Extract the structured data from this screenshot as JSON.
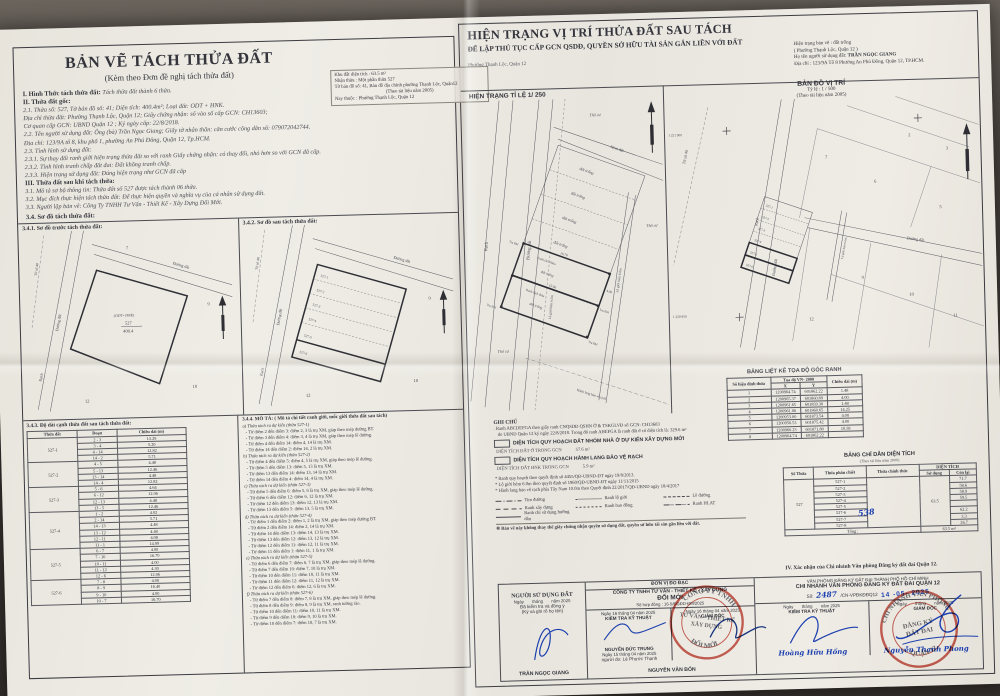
{
  "left": {
    "title": "BẢN VẼ TÁCH THỬA ĐẤT",
    "subtitle": "(Kèm theo Đơn đề nghị tách thửa đất)",
    "lines": [
      {
        "b": "I. Hình Thức tách thửa đất:",
        "t": "Tách thửa đất thành 6 thửa."
      },
      {
        "b": "II. Thửa đất gốc:",
        "t": ""
      },
      {
        "b": "",
        "t": "2.1. Thửa số: 527, Tờ bản đồ số: 41; Diện tích: 400.4m²; Loại đất: ODT + HNK."
      },
      {
        "b": "",
        "t": "Địa chỉ thửa đất: Phường Thạnh Lộc, Quận 12; Giấy chứng nhận: số vào sổ cấp GCN: CH13603;"
      },
      {
        "b": "",
        "t": "Cơ quan cấp GCN: UBND Quận 12 ; Ký ngày cấp: 22/8/2018."
      },
      {
        "b": "",
        "t": "2.2. Tên người sử dụng đất: Ông (bà) Trần Ngọc Giang; Giấy tờ nhân thân: căn cước công dân số: 079072042744."
      },
      {
        "b": "",
        "t": "Địa chỉ: 123/9A tổ 8, khu phố 1, phường An Phú Đông, Quận 12, Tp.HCM."
      },
      {
        "b": "",
        "t": "2.3. Tình hình sử dụng đất:"
      },
      {
        "b": "",
        "t": "2.3.1. Sự thay đổi ranh giới hiện trạng thửa đất so với ranh Giấy chứng nhận: có thay đổi, nhỏ hơn so với GCN đã cấp."
      },
      {
        "b": "",
        "t": "2.3.2. Tình hình tranh chấp đất đai: Đất không tranh chấp."
      },
      {
        "b": "",
        "t": "2.3.3. Hiện trạng sử dụng đất: Đúng hiện trạng như GCN đã cấp"
      },
      {
        "b": "III. Thửa đất sau khi tách thửa:",
        "t": ""
      },
      {
        "b": "",
        "t": "3.1. Mô tả sơ bộ thông tin: Thửa đất số 527 được tách thành 06 thửa."
      },
      {
        "b": "",
        "t": "3.2. Mục đích thực hiện tách thửa đất: Để thực hiện quyền và nghĩa vụ của cá nhân sử dụng đất."
      },
      {
        "b": "",
        "t": "3.3. Người lập bản vẽ: Công Ty TNHH Tư Vấn - Thiết Kế - Xây Dựng Đổi Mới."
      }
    ],
    "so_do_label": "3.4. Sơ đồ tách thửa đất:",
    "sketch1_title": "3.4.1. Sơ đồ trước tách thửa đất:",
    "sketch2_title": "3.4.2. Sơ đồ sau tách thửa đất:",
    "sketch": {
      "to_so": "Tờ số 40",
      "rach": "Rạch",
      "duong_dat": "Đường đất",
      "parcel_type": "(ODT+HNK)",
      "parcel_no": "527",
      "parcel_area": "400.4",
      "n7": "7",
      "n9": "9",
      "n10": "10",
      "n12": "12",
      "strips": [
        "527-1",
        "527-2",
        "527-3",
        "527-4",
        "527-5",
        "527-6"
      ]
    },
    "seg": {
      "title": "3.4.3. Độ dài cạnh thửa đất sau tách thửa đất:",
      "headers": [
        "Thửa đất",
        "Đoạn",
        "Chiều dài (m)"
      ],
      "groups": [
        {
          "id": "527-1",
          "rows": [
            [
              "2 - 3",
              "13.29"
            ],
            [
              "3 - 4",
              "5.20"
            ],
            [
              "4 - 14",
              "12.82"
            ],
            [
              "14 - 2",
              "5.71"
            ]
          ]
        },
        {
          "id": "527-2",
          "rows": [
            [
              "4 - 5",
              "4.48"
            ],
            [
              "5 - 13",
              "12.46"
            ],
            [
              "13 - 14",
              "4.48"
            ],
            [
              "14 - 4",
              "12.82"
            ]
          ]
        },
        {
          "id": "527-3",
          "rows": [
            [
              "5 - 6",
              "4.64"
            ],
            [
              "6 - 12",
              "12.06"
            ],
            [
              "12 - 13",
              "4.48"
            ],
            [
              "13 - 5",
              "12.46"
            ]
          ]
        },
        {
          "id": "527-4",
          "rows": [
            [
              "1 - 2",
              "4.02"
            ],
            [
              "2 - 14",
              "5.71"
            ],
            [
              "14 - 13",
              "4.48"
            ],
            [
              "13 - 12",
              "4.48"
            ],
            [
              "12 - 11",
              "4.08"
            ],
            [
              "11 - 1",
              "14.99"
            ]
          ]
        },
        {
          "id": "527-5",
          "rows": [
            [
              "6 - 7",
              "4.00"
            ],
            [
              "7 - 10",
              "16.70"
            ],
            [
              "10 - 11",
              "4.00"
            ],
            [
              "11 - 12",
              "4.30"
            ],
            [
              "12 - 6",
              "12.06"
            ]
          ]
        },
        {
          "id": "527-6",
          "rows": [
            [
              "7 - 8",
              "4.00"
            ],
            [
              "8 - 9",
              "16.40"
            ],
            [
              "9 - 10",
              "4.00"
            ],
            [
              "10 - 7",
              "16.70"
            ]
          ]
        }
      ]
    },
    "desc": {
      "title": "3.4.4. MÔ TẢ: ( Mô tả chi tiết ranh giới, mốc giới thửa đất sau tách)",
      "sections": [
        {
          "h": "a) Thửa tách ra dự kiến (thửa 527-1)",
          "lines": [
            "Từ điểm 2 đến điểm 3: điểm 2, 3 là trụ XM, giáp theo mép đường BT.",
            "Từ điểm 3 đến điểm 4: điểm 3, 4 là trụ XM, giáp theo mép lề đường.",
            "Từ điểm 4 đến điểm 14: điểm 4, 14 là trụ XM.",
            "Từ điểm 14 đến điểm 2: điểm 14, 2 là trụ XM."
          ]
        },
        {
          "h": "b) Thửa tách ra dự kiến (thửa 527-2)",
          "lines": [
            "Từ điểm 4 đến điểm 5: điểm 4, 5 là trụ XM, giáp theo mép lề đường.",
            "Từ điểm 5 đến điểm 13: điểm 5, 13 là trụ XM.",
            "Từ điểm 13 đến điểm 14: điểm 13, 14 là trụ XM.",
            "Từ điểm 14 đến điểm 4: điểm 14, 4 là trụ XM."
          ]
        },
        {
          "h": "c) Thửa tách ra dự kiến (thửa 527-3)",
          "lines": [
            "Từ điểm 5 đến điểm 6: điểm 5, 6 là trụ XM, giáp theo mép lề đường.",
            "Từ điểm 6 đến điểm 12: điểm 6, 12 là trụ XM.",
            "Từ điểm 12 đến điểm 13: điểm 12, 13 là trụ XM.",
            "Từ điểm 13 đến điểm 5: điểm 13, 5 là trụ XM."
          ]
        },
        {
          "h": "d) Thửa tách ra dự kiến (thửa 527-4)",
          "lines": [
            "Từ điểm 1 đến điểm 2: điểm 1, 2 là trụ XM, giáp theo mép đường BT.",
            "Từ điểm 2 đến điểm 14: điểm 2, 14 là trụ XM.",
            "Từ điểm 14 đến điểm 13: điểm 14, 13 là trụ XM.",
            "Từ điểm 13 đến điểm 12: điểm 13, 12 là trụ XM.",
            "Từ điểm 12 đến điểm 11: điểm 12, 11 là trụ XM.",
            "Từ điểm 11 đến điểm 1: điểm 11, 1 là trụ XM."
          ]
        },
        {
          "h": "e) Thửa tách ra dự kiến (thửa 527-5)",
          "lines": [
            "Từ điểm 6 đến điểm 7: điểm 6, 7 là trụ XM, giáp theo mép lề đường.",
            "Từ điểm 7 đến điểm 10: điểm 7, 10 là trụ XM.",
            "Từ điểm 10 đến điểm 11: điểm 10, 11 là trụ XM.",
            "Từ điểm 11 đến điểm 12: điểm 11, 12 là trụ XM.",
            "Từ điểm 12 đến điểm 6: điểm 12, 6 là trụ XM."
          ]
        },
        {
          "h": "f) Thửa tách ra dự kiến (thửa 527-6)",
          "lines": [
            "Từ điểm 7 đến điểm 8: điểm 7, 8 là trụ XM, giáp theo mép lề đường.",
            "Từ điểm 8 đến điểm 9: điểm 8, 9 là trụ XM, ranh tường rào.",
            "Từ điểm 10 đến điểm 11: điểm 10, 11 là trụ XM.",
            "Từ điểm 9 đến điểm 10: điểm 9, 10 là trụ XM.",
            "Từ điểm 10 đến điểm 7: điểm 10, 7 là trụ XM."
          ]
        }
      ]
    }
  },
  "right": {
    "title": "HIỆN TRẠNG VỊ TRÍ THỬA ĐẤT SAU TÁCH",
    "subtitle": "ĐỂ LẬP THỦ TỤC CẤP GCN QSDĐ, QUYỀN SỞ HỮU TÀI SẢN GẮN LIỀN VỚI ĐẤT",
    "locality": "Phường Thạnh Lộc, Quận 12",
    "info": {
      "l1": "Hiện trạng bản vẽ : đất trống",
      "l2": "( Phường Thạnh Lộc, Quận 12 )",
      "l3a": "Họ tên người sử dụng đất: ",
      "l3b": "TRẦN NGỌC GIANG",
      "l4": "Địa chỉ : 123/9A Tổ 8 Phường An Phú Đông, Quận 12, TP.HCM."
    },
    "khu": {
      "l1": "Khu đất diện tích :  63.5 m²",
      "l2": "Nhận thửa : Một phần thửa 527",
      "l3": "Tờ bản đồ số: 41, Bản đồ địa chính phường Thạnh Lộc, Quận12",
      "l4": "(Theo tài liệu năm 2005)",
      "l5": "Nay thuộc : Phường Thạnh Lộc, Quận 12"
    },
    "maps": {
      "hientrang": {
        "header": "HIỆN TRẠNG TỈ LỆ 1/ 250",
        "rach": "Rạch",
        "duong_dat": "Đường đất",
        "hem": "Hẻm đất",
        "lo_gioi": "Lộ giới hẻm 6.0m",
        "dat_trong": "đất trống",
        "tru": "Trụ BM",
        "tho_cu": "Thổ cư",
        "ranh_tach": "Ranh tách thửa",
        "hlat": "Hành lang bảo vệ rạch",
        "d1": "16.70",
        "d2": "12.06",
        "d3": "4.00"
      },
      "vitri": {
        "title": "BẢN ĐỒ VỊ TRÍ",
        "scale": "Tỷ lệ : 1 / 500",
        "note": "(Theo tài liệu năm 2005)",
        "to_so": "Tờ số 40",
        "rach": "Rạch",
        "duong_dat": "Đường đất",
        "lo_gioi": "Lộ giới hẻm 6.0m",
        "coord_top": "1 221 900",
        "coord_bottom": "1 220 950",
        "parcels": [
          "2",
          "3",
          "5",
          "6",
          "7",
          "9",
          "10",
          "11",
          "12"
        ],
        "strips": [
          "527-1",
          "527-2",
          "527-3",
          "527-4",
          "527-5",
          "527-6"
        ]
      }
    },
    "ghichu": {
      "title": "GHI CHÚ",
      "line1": ". Ranh ABCDEFGA theo giấy ranh CNQSDĐ QSHN Ở & TSKGLVĐ số GCN: CH13603",
      "line2": "do UBND Quận 12 ký ngày 22/8/2018. Trong đó ranh AHEFGA là ranh đất ở có diện tích là: 329.6 m²",
      "box1": "DIỆN TÍCH QUY HOẠCH ĐẤT NHÓM NHÀ Ở DỰ KIẾN XÂY DỰNG MỚI",
      "box1_sub": "DIỆN TÍCH ĐẤT Ở TRONG GCN",
      "box1_val": "57.6 m²",
      "box2": "DIỆN TÍCH QUY HOẠCH HÀNH LANG BẢO VỆ RẠCH",
      "box2_sub": "DIỆN TÍCH ĐẤT HNK TRONG GCN",
      "box2_val": "5.9 m²",
      "bullets": [
        "Ranh quy hoạch theo quyết định số 4455/QĐ-UBND-ĐT ngày 19/8/2013.",
        "Lộ giới hẻm 6.0m theo quyết định số 1960/QĐ-UBND-ĐT ngày 11/11/2015",
        "Hành lang bảo vệ rạch phía Tây Nam 10.0m theo Quyết định 22/2017/QĐ-UBND ngày 18/4/2017"
      ],
      "legend": [
        [
          "dashdot",
          "Tim đường"
        ],
        [
          "dotted",
          "Ranh lộ giới"
        ],
        [
          "dashed-sm",
          "Lề đường"
        ],
        [
          "dashed-lg",
          "Ranh xây dựng"
        ],
        [
          "dashed-fine",
          "Ranh bao đồng"
        ],
        [
          "dashdotdot",
          "Ranh HLAT"
        ],
        [
          "solid",
          "Ranh chỉ sử dụng hướng dẫn"
        ]
      ],
      "footnote": "※ Bản vẽ này không thay thế giấy chứng nhận quyền sử dụng đất, quyền sở hữu tài sản gắn liền với đất."
    },
    "coord_table": {
      "title": "BẢNG LIỆT KÊ TỌA ĐỘ GÓC RANH",
      "h_point": "Số hiệu đỉnh thửa",
      "h_coord": "Tọa độ VN- 2000",
      "h_x": "X",
      "h_y": "Y",
      "h_len": "Chiều dài (m)",
      "rows": [
        [
          "1",
          "1200964.74",
          "601862.22",
          "1.48"
        ],
        [
          "2",
          "1200965.37",
          "601860.89",
          "4.00"
        ],
        [
          "3",
          "1200961.65",
          "601859.30",
          "1.48"
        ],
        [
          "4",
          "1200961.06",
          "601860.65",
          "14.25"
        ],
        [
          "5",
          "1200953.00",
          "601873.54",
          "4.00"
        ],
        [
          "6",
          "1200956.53",
          "601875.42",
          "4.00"
        ],
        [
          "7",
          "1200960.23",
          "601871.80",
          "10.58"
        ],
        [
          "8",
          "1200964.74",
          "601862.22",
          ""
        ]
      ]
    },
    "area_table": {
      "title": "BẢNG CHỈ DẪN DIỆN TÍCH",
      "note": "(Theo tài liệu năm 2000)",
      "h_so": "Số Thửa",
      "h_phan": "Thửa phân chiết",
      "h_chinh": "Thửa chính thức",
      "h_dt": "DIỆN TÍCH",
      "h_sd": "Sử dụng",
      "h_cl": "Còn lại",
      "so_thua": "527",
      "handwritten": "538",
      "su_dung": "63.5",
      "rows": [
        [
          "527-1",
          "71.7"
        ],
        [
          "527-2",
          "58.6"
        ],
        [
          "527-3",
          "58.9"
        ],
        [
          "527-4",
          "59.5"
        ],
        [
          "527-5",
          ""
        ],
        [
          "527-6",
          "62.2"
        ],
        [
          "527-7",
          "3.3"
        ],
        [
          "527-8",
          "26.7"
        ]
      ],
      "total_label": "Tổng :",
      "total": "63.5 m²"
    },
    "confirm": "IV. Xác nhận của Chi nhánh Văn phòng Đăng ký đất đai Quận 12.",
    "sign": {
      "user": {
        "title": "NGƯỜI SỬ DỤNG ĐẤT",
        "date": "Ngày       tháng       năm 2025",
        "l1": "Đã kiểm tra và đồng ý",
        "l2": "(Ký và ghi rõ họ tên)",
        "name": "TRẦN NGỌC GIANG"
      },
      "unit": {
        "header": "ĐƠN VỊ ĐO ĐẠC",
        "c1": "CÔNG TY TNHH TƯ VẤN  - THIẾT KẾ - XÂY DỰNG",
        "c2": "ĐỔI MỚI",
        "contract": "Số hợp đồng : 16-5/ĐGĐD-ĐM/2025",
        "d1": "Ngày 16 tháng 04 năm 2025",
        "t1": "KIỂM TRA KỸ THUẬT",
        "n1": "NGUYỄN ĐỨC TRUNG",
        "d2": "Ngày 15 tháng 04 năm 2025",
        "measurer": "người đo: Lê Phước Thạnh",
        "d3": "Ngày 16 tháng 04 năm 2025",
        "t2": "GIÁM ĐỐC",
        "n2": "NGUYỄN VĂN BỐN",
        "stamp_top": "CÔNG TY TNHH",
        "stamp_m1": "TƯ VẤN - THIẾT KẾ",
        "stamp_m2": "XÂY DỰNG",
        "stamp_bot": "ĐỔI MỚI"
      },
      "office": {
        "l1": "VĂN PHÒNG ĐĂNG KÝ ĐẤT ĐAI THÀNH PHỐ HỒ CHÍ MINH",
        "l2": "CHI NHÁNH VĂN PHÒNG ĐĂNG KÝ ĐẤT ĐAI QUẬN 12",
        "so": "Số:",
        "so_val": "2487",
        "code": "/CN-VPĐKĐĐQ12",
        "date_stamp": "14 -05- 2025",
        "d1": "Ngày       tháng       năm 2025",
        "t1": "KIỂM TRA KỸ THUẬT",
        "sig1": "Hoàng Hữu Hồng",
        "d2": "Ngày       tháng       năm 2025",
        "t2": "GIÁM ĐỐC",
        "sig2": "Nguyễn Thanh Phong",
        "stamp_top": "CHI NHÁNH VĂN PHÒNG",
        "stamp_m1": "ĐĂNG KÝ",
        "stamp_m2": "ĐẤT ĐAI",
        "stamp_bot": "QUẬN 12"
      }
    }
  },
  "colors": {
    "ink": "#34343c",
    "blue_ink": "#1c3fae",
    "stamp_red": "#c23b2e",
    "paper": "#ece9e2"
  }
}
